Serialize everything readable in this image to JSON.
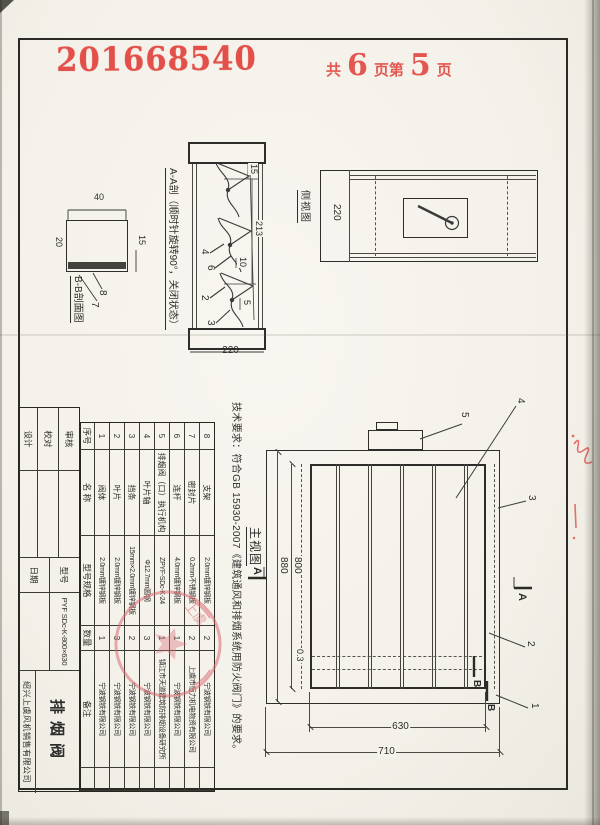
{
  "stamps": {
    "serial": "201668540",
    "pages": {
      "prefix": "共",
      "total": "6",
      "middle": "页第",
      "current": "5",
      "suffix": "页"
    }
  },
  "tech_note": "技术要求：符合GB 15930-2007《建筑通风和排烟系统用防火阀门》的要求。",
  "view_labels": {
    "side": "侧视图",
    "main": "主视图",
    "section_aa": "A-A剖（顺时针旋转90°，关闭状态）",
    "section_bb": "B-B剖面图"
  },
  "section_markers": {
    "a": "A",
    "b": "B"
  },
  "dims": {
    "side_depth": "220",
    "aa_15": "15",
    "aa_213": "213",
    "aa_10": "10",
    "aa_5": "5",
    "aa_total": "220",
    "bb_40": "40",
    "bb_15": "15",
    "bb_20": "20",
    "main_880": "880",
    "main_800": "800",
    "main_630": "630",
    "main_710": "710",
    "main_gap": "0.3"
  },
  "leaders": {
    "aa": [
      "4",
      "6",
      "2",
      "3"
    ],
    "bb": [
      "8",
      "7"
    ],
    "main": [
      "5",
      "4",
      "3",
      "2",
      "1"
    ]
  },
  "bom": {
    "headers": [
      "序号",
      "名 称",
      "型号规格",
      "数量",
      "备注"
    ],
    "rows": [
      {
        "no": "8",
        "name": "支架",
        "spec": "2.0mm镀锌钢板",
        "qty": "2",
        "remark": "宁波钢铁有限公司"
      },
      {
        "no": "7",
        "name": "密封片",
        "spec": "0.2mm不锈钢板",
        "qty": "2",
        "remark": "上虞市恒力机电物资有限公司"
      },
      {
        "no": "6",
        "name": "连杆",
        "spec": "4.0mm镀锌钢板",
        "qty": "1",
        "remark": "宁波钢铁有限公司"
      },
      {
        "no": "5",
        "name": "排烟阀（口）执行机构",
        "spec": "ZPYF-SDc-K-24",
        "qty": "1",
        "remark": "镇江市天道建筑防排烟设备研究所"
      },
      {
        "no": "4",
        "name": "叶片轴",
        "spec": "Φ12.7mm圆钢",
        "qty": "3",
        "remark": "宁波钢铁有限公司"
      },
      {
        "no": "3",
        "name": "挡条",
        "spec": "15mm×2.0mm镀锌钢板",
        "qty": "2",
        "remark": "宁波钢铁有限公司"
      },
      {
        "no": "2",
        "name": "叶片",
        "spec": "2.0mm镀锌钢板",
        "qty": "3",
        "remark": "宁波钢铁有限公司"
      },
      {
        "no": "1",
        "name": "阀体",
        "spec": "2.0mm镀锌钢板",
        "qty": "1",
        "remark": "宁波钢铁有限公司"
      }
    ]
  },
  "title_block": {
    "review_label": "审核",
    "check_label": "校对",
    "design_label": "设计",
    "model_label": "型号",
    "date_label": "日期",
    "model_value": "PYF SDc-K-800×630",
    "product_name": "排烟阀",
    "company": "绍兴上虞风机销售有限公司"
  },
  "seal": {
    "visible_chars": "上虞"
  }
}
